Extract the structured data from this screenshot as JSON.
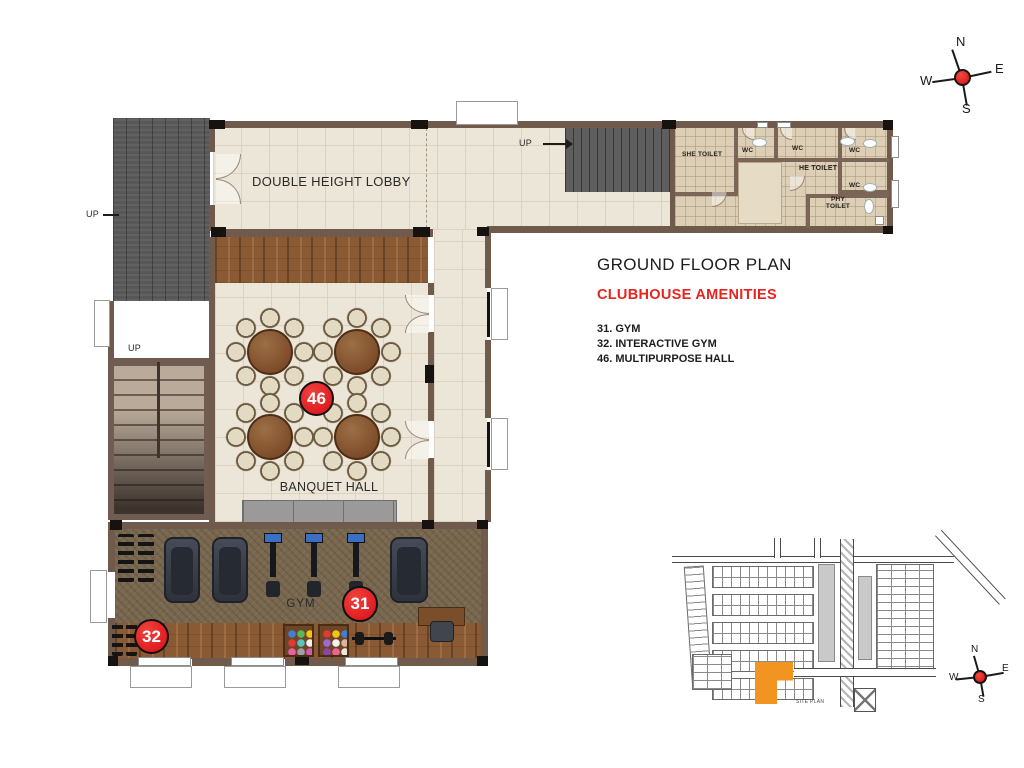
{
  "header": {
    "title": "GROUND FLOOR PLAN",
    "subtitle": "CLUBHOUSE AMENITIES",
    "amenities": [
      "31. GYM",
      "32. INTERACTIVE GYM",
      "46. MULTIPURPOSE HALL"
    ]
  },
  "plan": {
    "rooms": {
      "lobby": "DOUBLE HEIGHT LOBBY",
      "banquet_hall": "BANQUET HALL",
      "gym": "GYM",
      "she_toilet": "SHE TOILET",
      "he_toilet": "HE TOILET",
      "phy_toilet": "PHY TOILET",
      "wc": "WC",
      "up": "UP"
    },
    "markers": {
      "multipurpose_hall": "46",
      "gym": "31",
      "interactive_gym": "32"
    }
  },
  "compass": {
    "north": "N",
    "east": "E",
    "south": "S",
    "west": "W"
  },
  "site_plan": {
    "label": "SITE PLAN"
  },
  "colors": {
    "accent_red": "#ED1C24",
    "marker_red": "#E8151A",
    "wall_brown": "#6F5A4C",
    "floor_cream": "#ECE6D8",
    "toilet_floor": "#DDCFB6",
    "wood": "#8A5A35",
    "site_highlight_orange": "#F29422",
    "text_dark": "#231F20"
  }
}
